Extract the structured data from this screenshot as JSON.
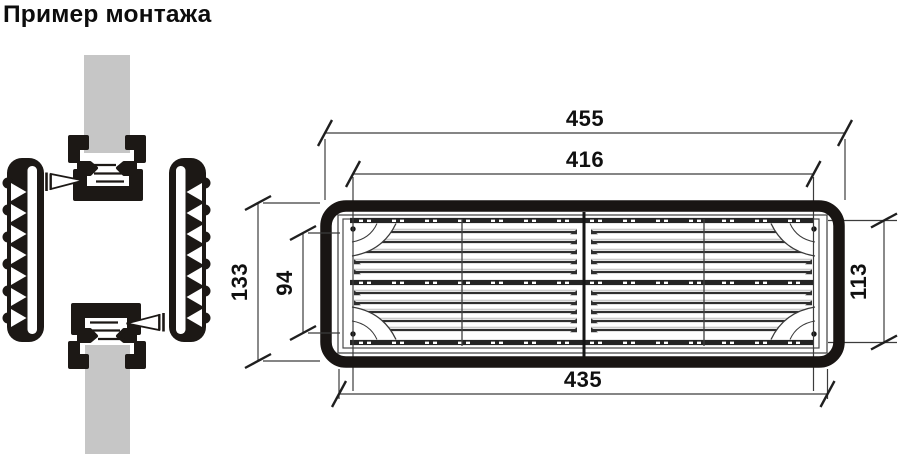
{
  "title": "Пример монтажа",
  "drawing": {
    "type": "technical-drawing",
    "views": {
      "installation_example": {
        "parts": [
          "duct-wall-top",
          "mounting-bracket-top",
          "screw-left",
          "grille-flange-left",
          "grille-flange-right",
          "mounting-bracket-bottom",
          "screw-right",
          "duct-wall-bottom"
        ]
      },
      "grille_front_view": {
        "dimensions_mm": {
          "outer_width": "455",
          "inner_width": "416",
          "flange_width": "435",
          "outer_height": "133",
          "inner_height": "94",
          "flange_height": "113"
        }
      }
    }
  },
  "colors": {
    "background": "#ffffff",
    "line_ink": "#1c1815",
    "duct_gray": "#c6c6c6",
    "dimension_line": "#3c3c3c",
    "text": "#0d0d0d"
  }
}
